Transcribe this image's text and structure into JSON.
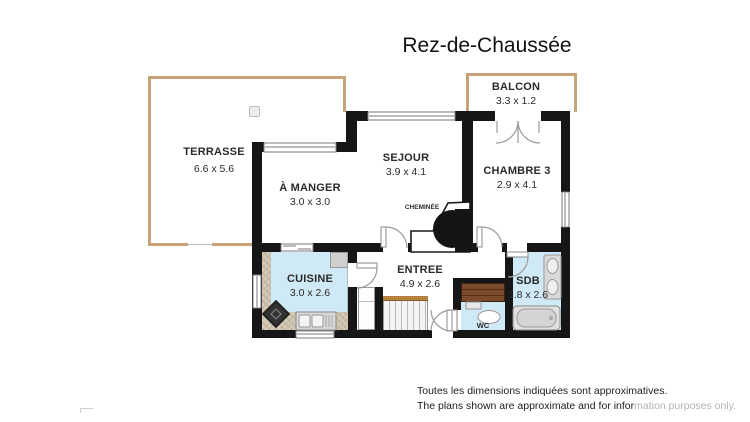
{
  "title": "Rez-de-Chaussée",
  "rooms": {
    "terrasse": {
      "name": "TERRASSE",
      "dims": "6.6 x 5.6"
    },
    "balcon": {
      "name": "BALCON",
      "dims": "3.3 x 1.2"
    },
    "sejour": {
      "name": "SEJOUR",
      "dims": "3.9 x 4.1"
    },
    "a_manger": {
      "name": "À MANGER",
      "dims": "3.0 x 3.0"
    },
    "chambre3": {
      "name": "CHAMBRE 3",
      "dims": "2.9 x 4.1"
    },
    "cuisine": {
      "name": "CUISINE",
      "dims": "3.0 x 2.6"
    },
    "entree": {
      "name": "ENTREE",
      "dims": "4.9 x 2.6"
    },
    "sdb": {
      "name": "SDB",
      "dims": "1.8 x 2.6"
    },
    "wc": {
      "name": "WC"
    },
    "cheminee": {
      "name": "CHEMINÉE"
    }
  },
  "disclaimer": {
    "line1": "Toutes les dimensions indiquées sont approximatives.",
    "line2_dark": "The plans shown are approximate and for infor",
    "line2_light": "mation purposes only."
  },
  "colors": {
    "wall": "#161616",
    "terrace_border": "#c7a478",
    "water_blue": "#cfe9f6",
    "mosaic": "#d6ccba",
    "wood_brown": "#794b2b",
    "rail_brown": "#b5813f",
    "fixture_grey": "#d2d2d2",
    "arc_grey": "#9b9b9b"
  }
}
